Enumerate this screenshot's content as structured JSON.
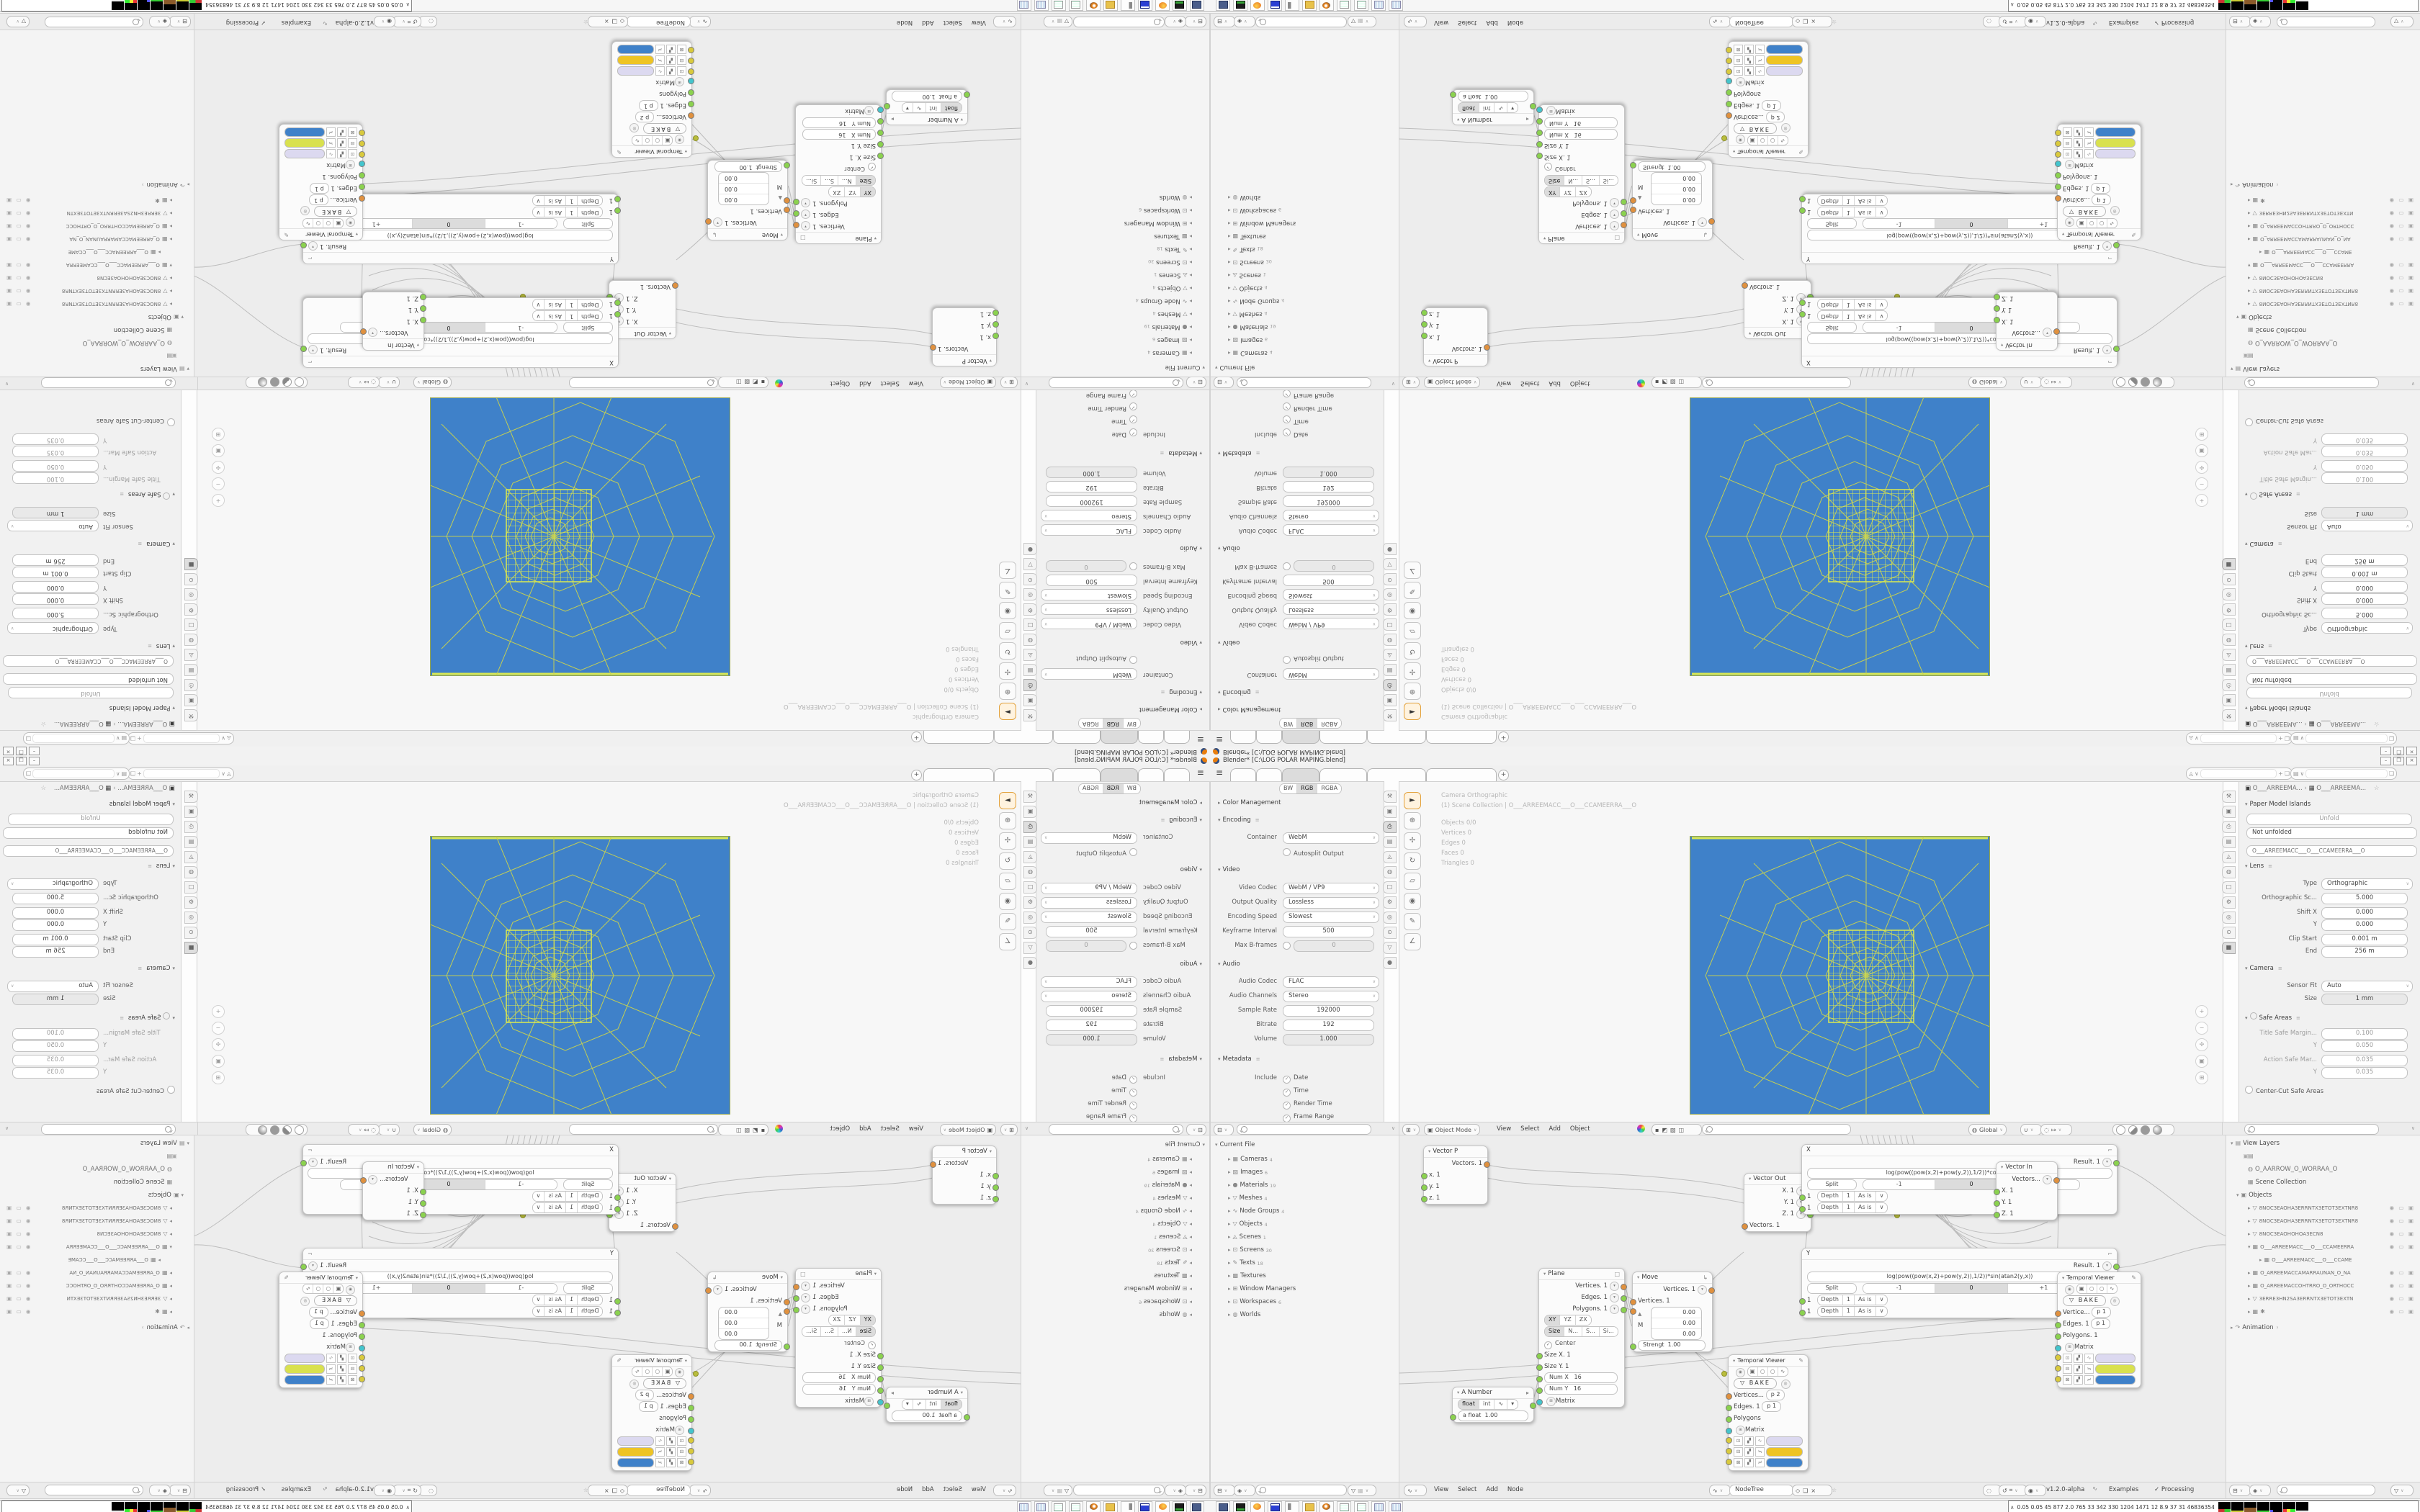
{
  "window": {
    "title": "Blender* [C:\\LOG POLAR MAPING.blend]",
    "minimize": "–",
    "restore": "❒",
    "close": "×"
  },
  "topbar": {
    "tabs": [
      "",
      "",
      "",
      "",
      "",
      ""
    ],
    "new_tab": "+"
  },
  "props_left": {
    "format": {
      "label": "Color",
      "opts": [
        "BW",
        "RGB",
        "RGBA"
      ]
    },
    "color_management": "Color Management",
    "encoding": {
      "title": "Encoding",
      "container_label": "Container",
      "container": "WebM",
      "autosplit": "Autosplit Output"
    },
    "video": {
      "title": "Video",
      "codec_label": "Video Codec",
      "codec": "WebM / VP9",
      "quality_label": "Output Quality",
      "quality": "Lossless",
      "speed_label": "Encoding Speed",
      "speed": "Slowest",
      "keyframe_label": "Keyframe Interval",
      "keyframe": "500",
      "maxb_label": "Max B-frames",
      "maxb": "0"
    },
    "audio": {
      "title": "Audio",
      "codec_label": "Audio Codec",
      "codec": "FLAC",
      "channels_label": "Audio Channels",
      "channels": "Stereo",
      "rate_label": "Sample Rate",
      "rate": "192000",
      "bitrate_label": "Bitrate",
      "bitrate": "192",
      "volume_label": "Volume",
      "volume": "1.000"
    },
    "metadata": {
      "title": "Metadata",
      "include_label": "Include",
      "checks": [
        "Date",
        "Time",
        "Render Time",
        "Frame Range"
      ]
    }
  },
  "viewport": {
    "stats": {
      "line1": "Camera Orthographic",
      "line2": "(1) Scene Collection | O___ARREEMACC___O___CCAMEERRA___O",
      "objects": "Objects    0/0",
      "vertices": "Vertices    0",
      "edges": "Edges    0",
      "faces": "Faces    0",
      "triangles": "Triangles    0"
    },
    "header": {
      "mode": "Object Mode",
      "menu_view": "View",
      "menu_select": "Select",
      "menu_add": "Add",
      "menu_object": "Object",
      "orientation": "Global"
    }
  },
  "props_right": {
    "breadcrumb_a": "O___ARREEMA...",
    "breadcrumb_b": "O___ARREEMA...",
    "paper": {
      "title": "Paper Model Islands",
      "unfold": "Unfold",
      "status": "Not unfolded"
    },
    "data_id": "O___ARREEMACC___O___CCAMEERRA___O",
    "lens": {
      "title": "Lens",
      "type_label": "Type",
      "type": "Orthographic",
      "scale_label": "Orthographic Sc...",
      "scale": "5.000",
      "shiftx_label": "Shift X",
      "shiftx": "0.000",
      "shifty_label": "Y",
      "shifty": "0.000",
      "clip_label": "Clip Start",
      "clip": "0.001 m",
      "end_label": "End",
      "end": "256 m"
    },
    "camera": {
      "title": "Camera",
      "fit_label": "Sensor Fit",
      "fit": "Auto",
      "size_label": "Size",
      "size": "1 mm"
    },
    "safe": {
      "title": "Safe Areas",
      "r1l": "Title Safe Margin...",
      "r1v": "0.100",
      "r2l": "Y",
      "r2v": "0.050",
      "r3l": "Action Safe Mar...",
      "r3v": "0.035",
      "r4l": "Y",
      "r4v": "0.035",
      "center": "Center-Cut Safe Areas"
    }
  },
  "outliner_left": {
    "root": "Current File",
    "items": [
      {
        "label": "Cameras",
        "count": "4"
      },
      {
        "label": "Images",
        "count": "6"
      },
      {
        "label": "Materials",
        "count": "19"
      },
      {
        "label": "Meshes",
        "count": "4"
      },
      {
        "label": "Node Groups",
        "count": "4"
      },
      {
        "label": "Objects",
        "count": "4"
      },
      {
        "label": "Scenes",
        "count": "1"
      },
      {
        "label": "Screens",
        "count": "30"
      },
      {
        "label": "Texts",
        "count": "18"
      },
      {
        "label": "Textures",
        "count": ""
      },
      {
        "label": "Window Managers",
        "count": ""
      },
      {
        "label": "Workspaces",
        "count": "6"
      },
      {
        "label": "Worlds",
        "count": ""
      }
    ]
  },
  "outliner_right": {
    "root": "View Layers",
    "viewlayer": "O_AARROW_O_WORRAA_O",
    "collection": "Scene Collection",
    "objects_label": "Objects",
    "items": [
      "8NOC3EAOHA3ERRNTX3ETOT3EXTNR8",
      "8NOC3EAOHA3ERRNTX3ETOT3EXTNR8",
      "8NOC3EAOHOHOA3ECN8",
      "O___ARREEMACC___O___CCAMEERRA",
      "O___ARREEMACC___O___CCAME",
      "O_ARREEMACCAMARRAUNAN_O_NA",
      "O_ARREEMACCOHTRRO_O_ORTHOCC",
      "3ERRE3HN2SA3ERRNTX3ETOT3EXTN"
    ],
    "animation": "Animation"
  },
  "node_editor": {
    "menu_view": "View",
    "menu_select": "Select",
    "menu_add": "Add",
    "menu_node": "Node",
    "tree_name": "NodeTree",
    "sverchok": {
      "version": "v1.2.0-alpha",
      "examples": "Examples",
      "processing": "Processing"
    },
    "nodes": {
      "vector_p": {
        "title": "Vector P",
        "r1": "Vectors. 1",
        "x": "x. 1",
        "y": "y. 1",
        "z": "z. 1"
      },
      "a_number": {
        "title": "A Number",
        "m1": "float",
        "m2": "int",
        "field_label": "a float",
        "field_value": "1.00"
      },
      "plane": {
        "title": "Plane",
        "o1": "Vertices. 1",
        "o2": "Edges. 1",
        "o3": "Polygons. 1",
        "ax1": "XY",
        "ax2": "YZ",
        "ax3": "ZX",
        "sm1": "Size",
        "sm2": "N...",
        "sm3": "S...",
        "sm4": "Si...",
        "center": "Center",
        "in1": "Size X. 1",
        "in2": "Size Y. 1",
        "numx_label": "Num X",
        "numx": "16",
        "numy_label": "Num Y",
        "numy": "16",
        "matrix": "Matrix"
      },
      "move": {
        "title": "Move",
        "out": "Vertices. 1",
        "in": "Vertices. 1",
        "m": "M",
        "v1": "0.00",
        "v2": "0.00",
        "v3": "0.00",
        "strength_label": "Strengt",
        "strength": "1.00"
      },
      "vector_out": {
        "title": "Vector Out",
        "x": "X. 1",
        "y": "Y. 1",
        "z": "Z. 1",
        "in": "Vectors. 1"
      },
      "fx": {
        "title": "X",
        "result": "Result. 1",
        "formula": "log(pow((pow(x,2)+pow(y,2)),1/2))*cos(atan2(y,x))",
        "split": "Split",
        "w1": "-1",
        "w2": "0",
        "w3": "+1",
        "n1": "1",
        "depth_label": "Depth",
        "depth": "1",
        "asis": "As is"
      },
      "fy": {
        "title": "Y",
        "result": "Result. 1",
        "formula": "log(pow((pow(x,2)+pow(y,2)),1/2))*sin(atan2(y,x))",
        "split": "Split",
        "w1": "-1",
        "w2": "0",
        "w3": "+1",
        "n1": "1",
        "depth_label": "Depth",
        "depth": "1",
        "asis": "As is"
      },
      "vector_in": {
        "title": "Vector In",
        "out": "Vectors...",
        "x": "X. 1",
        "y": "Y. 1",
        "z": "Z. 1"
      },
      "tv_right": {
        "title": "Temporal Viewer",
        "bake": "BAKE",
        "r1l": "Vertice...",
        "r1v": "p  1",
        "r2l": "Edges. 1",
        "r2v": "p  1",
        "r3l": "Polygons. 1",
        "matrix": "Matrix"
      },
      "tv_left": {
        "title": "Temporal Viewer",
        "bake": "BAKE",
        "r1l": "Vertices...",
        "r1v": "p  2",
        "r2l": "Edges. 1",
        "r2v": "p  1",
        "r3l": "Polygons",
        "matrix": "Matrix"
      }
    }
  },
  "taskbar": {
    "monitor": "0.05 0.05  45  877  2.0  765  33  342 330 1204 1471  12  8.9  37  31  46836354"
  },
  "colors": {
    "viewport_blue": "#3f81c9",
    "wire_yellow": "#c9d24f",
    "wire_bright": "#dcea51",
    "socket_orange": "#e0913f",
    "socket_green": "#8bd24f",
    "socket_cyan": "#43c5cd",
    "swatch_lavender": "#dcd9f0",
    "swatch_gold": "#eec424",
    "swatch_lime": "#d9e14e"
  }
}
